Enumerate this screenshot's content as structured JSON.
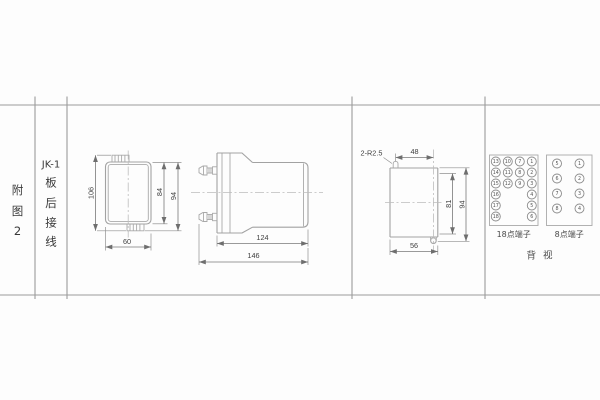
{
  "sheet": {
    "figure_label_chars": [
      "附",
      "图",
      "2"
    ],
    "title": {
      "model": "JK-1",
      "chars": [
        "板",
        "后",
        "接",
        "线"
      ]
    }
  },
  "front_view": {
    "dim_height_overall": "106",
    "dim_height_body": "84",
    "dim_height_outer": "94",
    "dim_width": "60"
  },
  "side_view": {
    "dim_depth_body": "124",
    "dim_depth_total": "146"
  },
  "cutout_view": {
    "note_radius": "2-R2.5",
    "dim_width_top": "48",
    "dim_height_holes": "81",
    "dim_height_overall": "94",
    "dim_width_bottom": "56"
  },
  "rear_view": {
    "terminal_18": {
      "label": "18点端子",
      "grid": [
        [
          "13",
          "10",
          "7",
          "1"
        ],
        [
          "14",
          "11",
          "8",
          "2"
        ],
        [
          "15",
          "12",
          "9",
          "3"
        ],
        [
          "16",
          "",
          "",
          "4"
        ],
        [
          "17",
          "",
          "",
          "5"
        ],
        [
          "18",
          "",
          "",
          "6"
        ]
      ]
    },
    "terminal_8": {
      "label": "8点端子",
      "grid": [
        [
          "5",
          "1"
        ],
        [
          "6",
          "2"
        ],
        [
          "7",
          "3"
        ],
        [
          "8",
          "4"
        ]
      ]
    },
    "caption": "背 视"
  },
  "colors": {
    "outline": "#a2a2a2",
    "dimension": "#787878",
    "text": "#3f3f3f",
    "frame": "#9b9b9b",
    "background": "#fdfdfd"
  }
}
